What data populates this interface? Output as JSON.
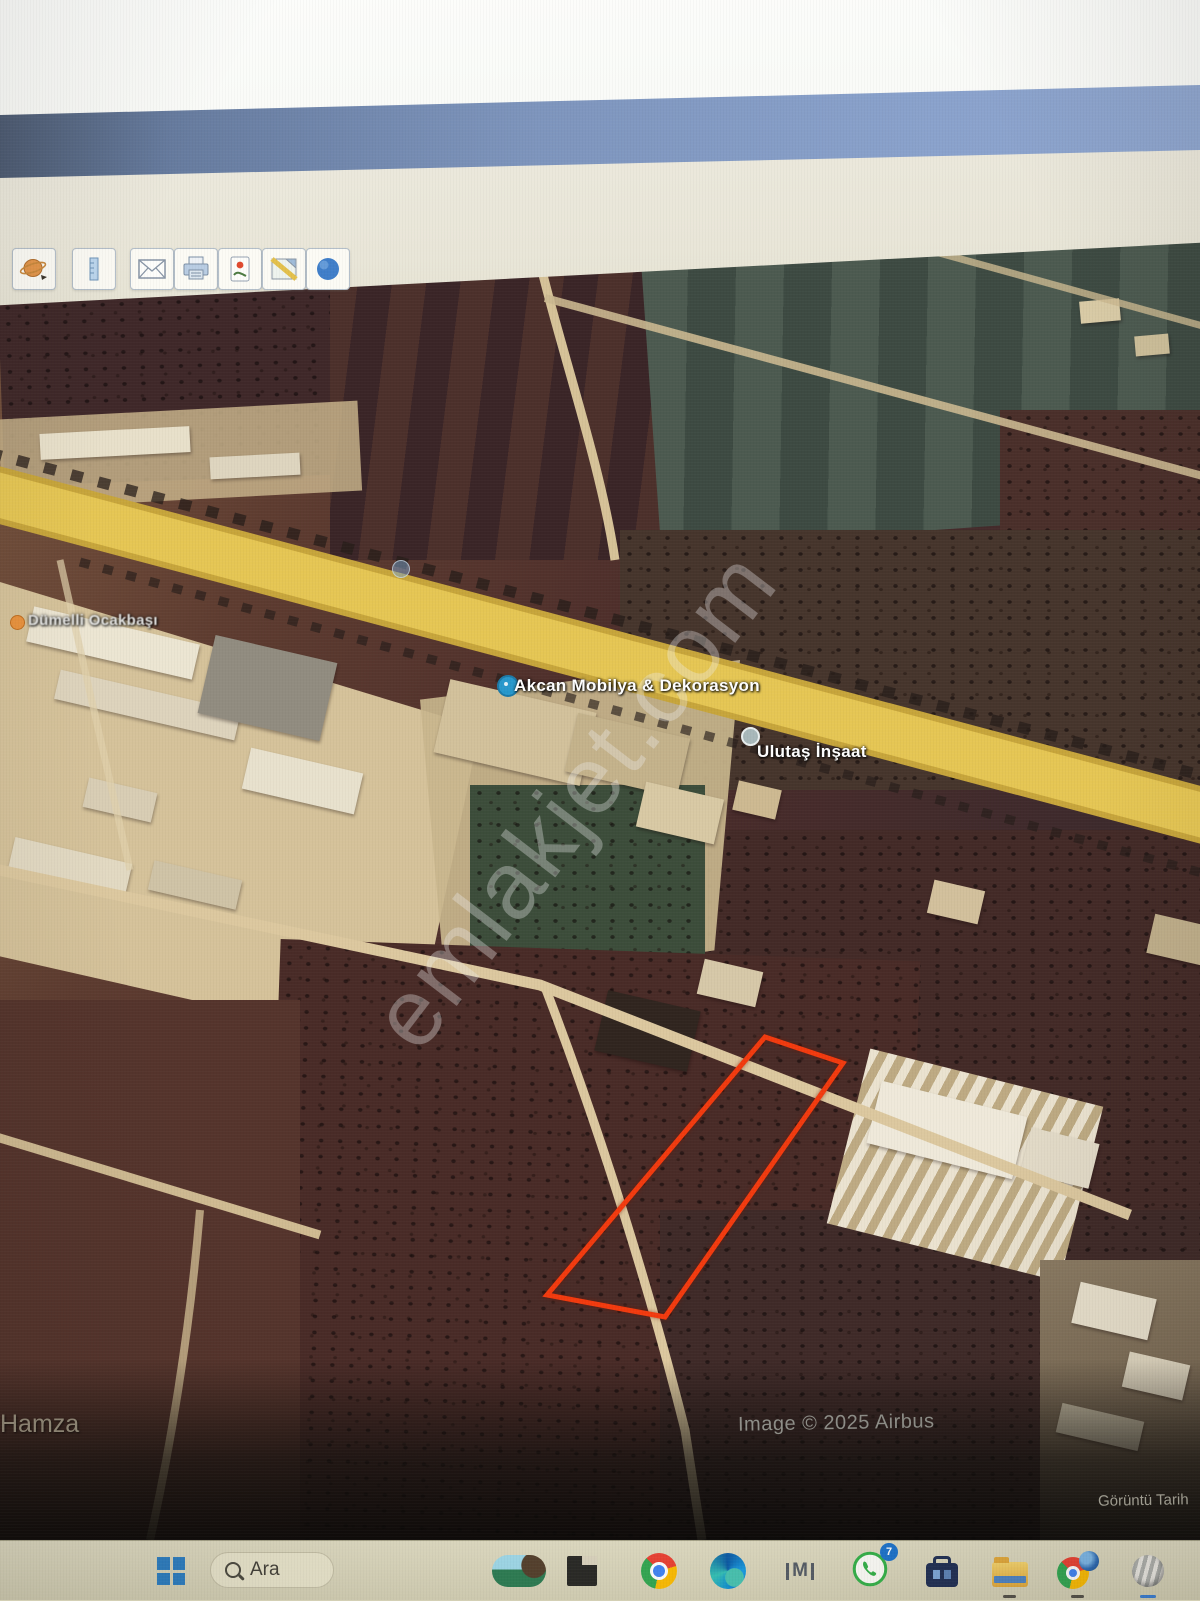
{
  "earth_toolbar": {
    "icons": [
      "planet-icon",
      "ruler-icon",
      "email-icon",
      "print-icon",
      "save-image-icon",
      "map-view-icon",
      "globe-icon"
    ]
  },
  "map": {
    "pois": [
      {
        "label": "Dümelli Ocakbaşı",
        "pin": "orange-poi-pin"
      },
      {
        "label": "Akcan Mobilya & Dekorasyon",
        "pin": "blue-poi-pin"
      },
      {
        "label": "Ulutaş İnşaat",
        "pin": "gray-poi-pin"
      }
    ],
    "place_label": "Hamza",
    "attribution": "Image © 2025 Airbus",
    "date_label": "Görüntü Tarih",
    "watermark": "emlakjet.com",
    "parcel_color": "#f23a0e",
    "highway_color": "#e5c654"
  },
  "taskbar": {
    "search_label": "Ara",
    "whatsapp_badge": "7",
    "icons": [
      "windows-start-icon",
      "search-input",
      "widgets-icon",
      "dark-window-app-icon",
      "chrome-icon",
      "edge-icon",
      "im-app-icon",
      "whatsapp-icon",
      "briefcase-app-icon",
      "file-explorer-icon",
      "chrome-earth-icon",
      "google-earth-icon"
    ]
  }
}
